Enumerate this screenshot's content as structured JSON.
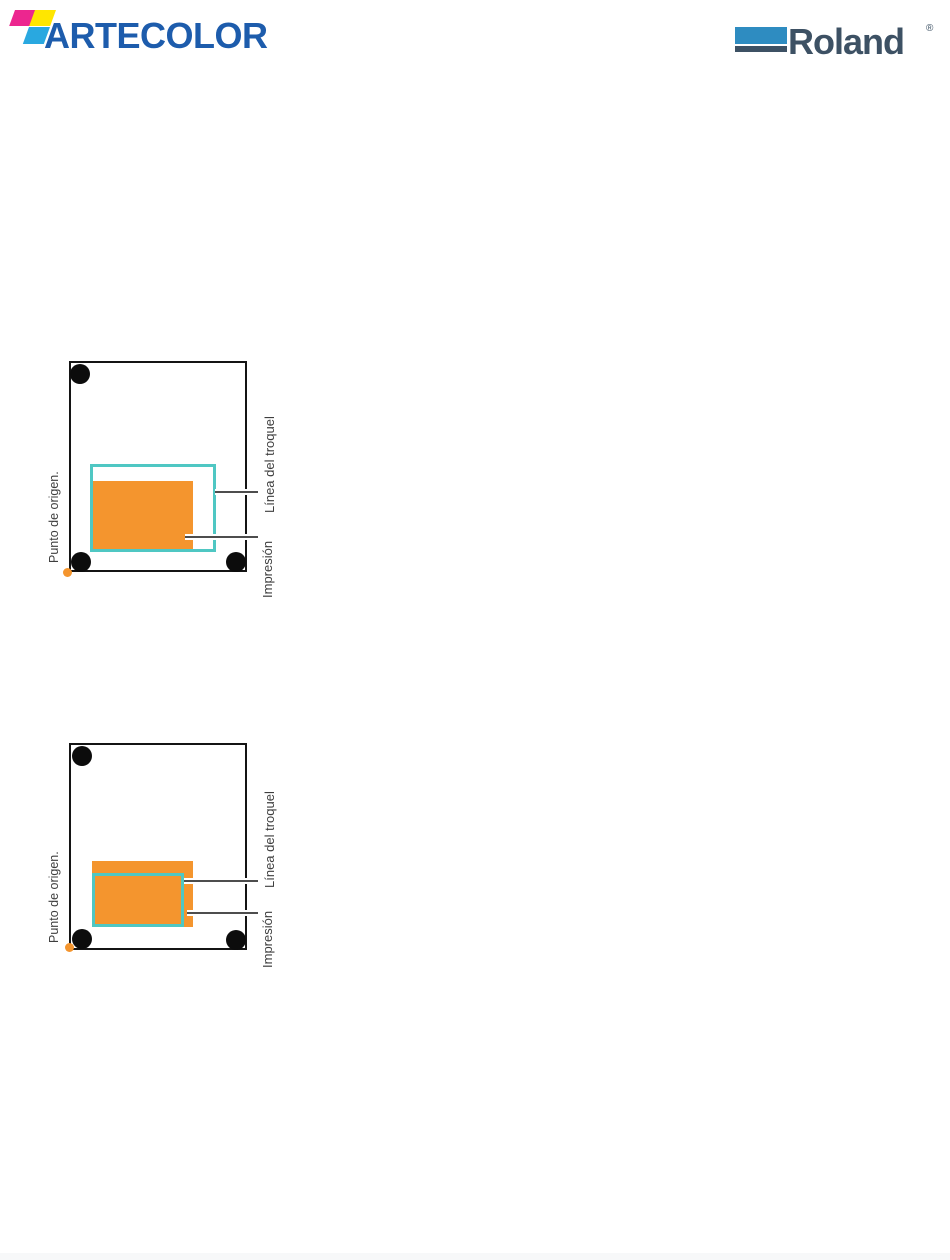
{
  "header": {
    "artecolor": {
      "text": "ARTECOLOR",
      "blue": "#1d5cac",
      "mark_colors": {
        "magenta": "#ec268f",
        "yellow": "#ffe600",
        "cyan": "#29a8e0"
      }
    },
    "roland": {
      "text": "Roland",
      "reg": "®",
      "bar_blue": "#2e8cc1",
      "slate": "#3d5164"
    }
  },
  "diagrams": [
    {
      "origin_label": "Punto de origen.",
      "die_line_label": "Línea del troquel",
      "print_label": "Impresión"
    },
    {
      "origin_label": "Punto de origen.",
      "die_line_label": "Línea del troquel",
      "print_label": "Impresión"
    }
  ],
  "colors": {
    "print_orange": "#f4952e",
    "die_teal": "#4fc7c3",
    "leader_gray": "#4d4d4d",
    "mark_black": "#0c0c0c",
    "label_text": "#3e3e3e"
  }
}
